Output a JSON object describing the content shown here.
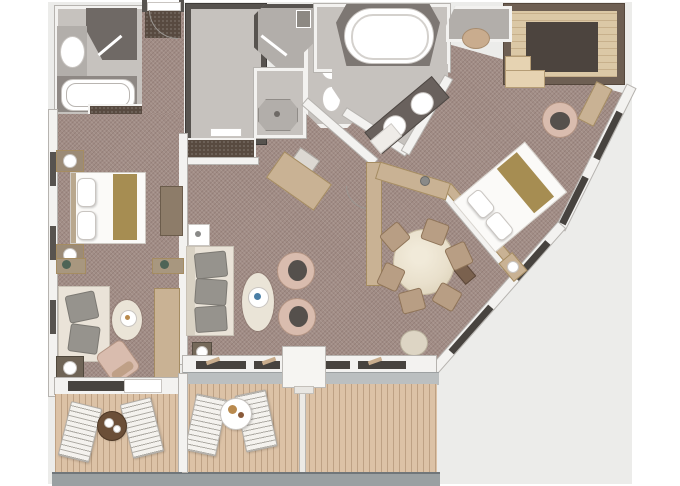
{
  "meta": {
    "type": "floor-plan",
    "description": "top-down rendered floor plan of a two-bedroom suite with verandas",
    "width": 680,
    "height": 486
  },
  "colors": {
    "backdrop": "#ececea",
    "wall": "#f3f2f0",
    "wall_edge": "#b6b3af",
    "dark_wall": "#57534f",
    "carpet": "#a28d86",
    "closet_brown": "#584a40",
    "floor_grey": "#c6c2be",
    "floor_grey_dark": "#b2aeaa",
    "tile_dark": "#6f6965",
    "wood_light": "#dbc8a6",
    "wood_mid": "#c9b294",
    "wood_dark": "#7a614e",
    "wood_edge": "#a58c62",
    "deck": "#dcc2a6",
    "railing": "#9aa0a2",
    "balcony_cap": "#bbbfc0",
    "fixture": "#ffffff",
    "fixture_rim": "#c9c5c1",
    "sofa_cream": "#eae3d8",
    "cushion_grey": "#96938d",
    "chair_tan": "#d9bcae",
    "chair_seat": "#55504c",
    "dining_chair": "#b89e84",
    "bed_gold": "#a68d52",
    "table_cream": "#e9e0cc",
    "rug_cream": "#eae4d7",
    "glass_dark": "#47433f",
    "accent_blue": "#4a7fa6",
    "ottoman_tan": "#c9ac8e",
    "table_brown": "#6b4f38",
    "dark_panel": "#4c443e"
  },
  "rooms": [
    {
      "id": "guest-bathroom",
      "features": [
        "washbasin",
        "shower",
        "bathtub"
      ]
    },
    {
      "id": "guest-closet",
      "features": [
        "wardrobe",
        "dresser"
      ]
    },
    {
      "id": "entry-corridor",
      "features": [
        "entry-door",
        "door-mat"
      ]
    },
    {
      "id": "walk-in-closet",
      "features": []
    },
    {
      "id": "shower-room",
      "features": [
        "shower",
        "bench"
      ]
    },
    {
      "id": "shower-stall",
      "features": [
        "shower-tray",
        "drain"
      ]
    },
    {
      "id": "wc-room",
      "features": [
        "toilet",
        "bidet"
      ]
    },
    {
      "id": "master-bathroom",
      "features": [
        "oval-bathtub",
        "double-vanity",
        "bath-mat"
      ]
    },
    {
      "id": "dressing-room",
      "features": [
        "wardrobe-panel",
        "bench"
      ]
    },
    {
      "id": "bay-alcove",
      "features": [
        "ottoman"
      ]
    },
    {
      "id": "guest-bedroom",
      "features": [
        "double-bed",
        "nightstand",
        "nightstand",
        "tv-cabinet",
        "plant-console",
        "plant-console",
        "sofa",
        "armchair",
        "rug",
        "cocktail-table",
        "side-table",
        "long-counter",
        "balcony-door"
      ]
    },
    {
      "id": "guest-balcony",
      "features": [
        "sun-lounger",
        "sun-lounger",
        "round-table",
        "railing"
      ]
    },
    {
      "id": "living-room",
      "features": [
        "sofa",
        "minibar-cabinet",
        "rug",
        "coffee-table",
        "tub-chair",
        "tub-chair",
        "sideboard",
        "desk-chair",
        "console",
        "console",
        "side-table",
        "window",
        "balcony-door"
      ]
    },
    {
      "id": "dining-area",
      "features": [
        "oval-table",
        "dining-chair",
        "dining-chair",
        "dining-chair",
        "dining-chair",
        "dining-chair",
        "dining-chair",
        "pouf"
      ]
    },
    {
      "id": "master-bedroom",
      "features": [
        "double-bed",
        "pillows",
        "gold-runner",
        "headboard-wall",
        "nightstand",
        "media-console",
        "armchair",
        "desk",
        "ottoman",
        "hull-windows"
      ]
    },
    {
      "id": "main-balcony",
      "features": [
        "sun-lounger",
        "sun-lounger",
        "round-table",
        "deck-divider",
        "railing"
      ]
    }
  ]
}
